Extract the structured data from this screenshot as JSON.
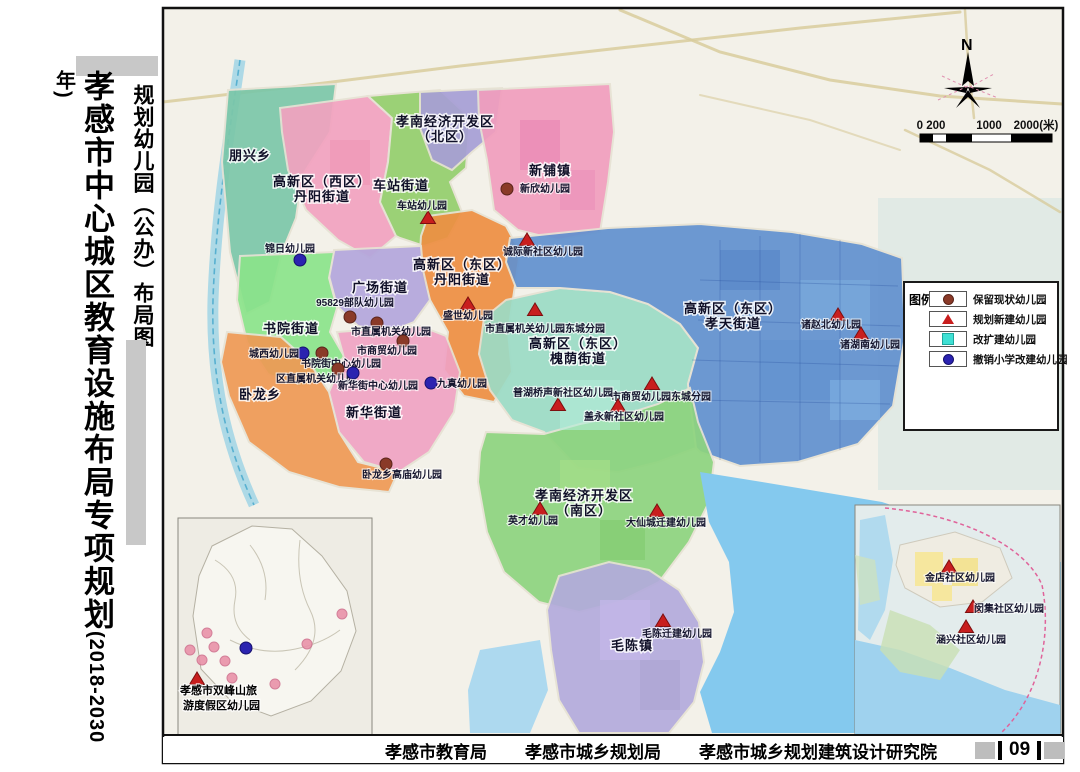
{
  "titles": {
    "main": "孝感市中心城区教育设施布局专项规划",
    "main_year": "(2018-2030年)",
    "sub": "规划幼儿园（公办）布局图"
  },
  "footer": {
    "agencies": [
      "孝感市教育局",
      "孝感市城乡规划局",
      "孝感市城乡规划建筑设计研究院"
    ],
    "page_number": "09"
  },
  "map": {
    "north_label": "N",
    "scale_ticks": [
      "0 200",
      "1000",
      "2000(米)"
    ],
    "legend": {
      "title": "图例：",
      "items": [
        {
          "symbol": "circle",
          "color": "#8a3a28",
          "edge": "#5a241a",
          "label": "保留现状幼儿园"
        },
        {
          "symbol": "triangle",
          "color": "#c81e1e",
          "edge": "#7d0f0f",
          "label": "规划新建幼儿园"
        },
        {
          "symbol": "square",
          "color": "#3fe0d4",
          "edge": "#1fa89e",
          "label": "改扩建幼儿园"
        },
        {
          "symbol": "circle",
          "color": "#2b23b0",
          "edge": "#16106e",
          "label": "撤销小学改建幼儿园"
        }
      ]
    },
    "marker_styles": {
      "existing": {
        "shape": "circle",
        "fill": "#8a3a28",
        "edge": "#5a241a"
      },
      "planned": {
        "shape": "triangle",
        "fill": "#c81e1e",
        "edge": "#7d0f0f"
      },
      "converted": {
        "shape": "circle",
        "fill": "#2b23b0",
        "edge": "#16106e"
      },
      "inset_existing": {
        "shape": "circle",
        "fill": "#e98fa7",
        "edge": "#cf6f8d"
      }
    },
    "districts": [
      {
        "id": "pengxing-township",
        "color": "#7cc7a9",
        "label_lines": [
          "朋兴乡"
        ],
        "label_x": 250,
        "label_y": 160,
        "points": "228,90 336,84 330,132 302,176 296,218 282,252 270,302 246,314 230,252 222,162"
      },
      {
        "id": "gaoxin-west-danyang",
        "color": "#f2a2c0",
        "label_lines": [
          "高新区（西区）",
          "丹阳街道"
        ],
        "label_x": 322,
        "label_y": 186,
        "points": "280,108 368,96 392,118 388,162 380,202 396,236 370,258 338,240 306,210 288,170 282,132"
      },
      {
        "id": "chezhan-street",
        "color": "#94cf6d",
        "label_lines": [
          "车站街道"
        ],
        "label_x": 401,
        "label_y": 190,
        "points": "368,96 440,90 470,118 466,168 450,182 462,212 448,238 424,246 400,238 396,236 380,202 388,162 392,118"
      },
      {
        "id": "kaifaqu-north",
        "color": "#a79fd6",
        "label_lines": [
          "孝南经济开发区",
          "（北区）"
        ],
        "label_x": 445,
        "label_y": 126,
        "points": "420,92 502,88 496,132 472,152 452,170 432,160 420,128"
      },
      {
        "id": "xinpu-town",
        "color": "#f19ebe",
        "label_lines": [
          "新铺镇"
        ],
        "label_x": 550,
        "label_y": 175,
        "points": "478,90 610,84 614,132 608,182 600,232 558,240 518,230 494,210 487,160 479,120"
      },
      {
        "id": "gaoxin-east-danyang",
        "color": "#ee8f42",
        "label_lines": [
          "高新区（东区）",
          "丹阳街道"
        ],
        "label_x": 462,
        "label_y": 269,
        "points": "428,216 472,210 506,226 520,252 514,292 508,332 512,372 494,402 464,396 444,370 448,332 430,300 419,268 421,236"
      },
      {
        "id": "guangchang-street",
        "color": "#b4a7dc",
        "label_lines": [
          "广场街道"
        ],
        "label_x": 380,
        "label_y": 292,
        "points": "334,250 421,246 423,270 430,300 414,322 388,332 358,326 337,306 329,276"
      },
      {
        "id": "shuyuan-street",
        "color": "#8be48b",
        "label_lines": [
          "书院街道"
        ],
        "label_x": 291,
        "label_y": 333,
        "points": "240,256 334,252 329,278 337,308 330,332 344,356 329,380 299,387 268,374 247,342 237,300"
      },
      {
        "id": "xinhua-street",
        "color": "#f0a3c4",
        "label_lines": [
          "新华街道"
        ],
        "label_x": 374,
        "label_y": 417,
        "points": "337,332 420,326 446,336 460,372 454,412 429,452 399,472 364,462 339,432 329,392 344,358"
      },
      {
        "id": "wolong-township",
        "color": "#ef9a55",
        "label_lines": [
          "卧龙乡"
        ],
        "label_x": 260,
        "label_y": 399,
        "points": "227,332 281,337 309,362 329,392 339,432 358,462 398,472 389,492 339,487 289,472 249,442 229,396 221,362"
      },
      {
        "id": "gaoxin-east-huaiyin",
        "color": "#9cdcc6",
        "label_lines": [
          "高新区（东区）",
          "槐荫街道"
        ],
        "label_x": 578,
        "label_y": 348,
        "points": "506,300 560,288 610,292 648,304 680,324 698,348 688,384 696,448 658,462 618,472 578,468 544,432 512,420 490,390 479,354 484,318"
      },
      {
        "id": "gaoxin-east-xiaotian",
        "color": "#6191cf",
        "label_lines": [
          "高新区（东区）",
          "孝天街道"
        ],
        "label_x": 733,
        "label_y": 313,
        "points": "510,238 608,228 700,224 792,232 862,244 902,258 905,336 893,406 858,444 798,462 740,466 700,452 696,448 688,384 698,348 680,324 648,304 610,292 560,288 516,288 506,262"
      },
      {
        "id": "kaifaqu-south",
        "color": "#8ed47f",
        "label_lines": [
          "孝南经济开发区",
          "（南区）"
        ],
        "label_x": 584,
        "label_y": 500,
        "points": "486,432 544,434 580,424 620,416 658,404 690,388 698,422 714,462 709,502 689,542 659,582 619,602 579,612 539,602 504,572 487,532 478,482 480,452"
      },
      {
        "id": "maochen-town",
        "color": "#b3abdc",
        "label_lines": [
          "毛陈镇"
        ],
        "label_x": 632,
        "label_y": 650,
        "points": "559,576 609,562 649,570 679,590 699,622 704,662 694,702 669,733 579,733 559,700 551,650 547,610"
      }
    ],
    "markers": [
      {
        "type": "existing",
        "x": 507,
        "y": 189,
        "label": "新欣幼儿园",
        "lx": 545,
        "ly": 192,
        "anchor": "middle"
      },
      {
        "type": "existing",
        "x": 350,
        "y": 317,
        "label": "95829部队幼儿园",
        "lx": 355,
        "ly": 306,
        "anchor": "middle"
      },
      {
        "type": "existing",
        "x": 377,
        "y": 323,
        "label": "市直属机关幼儿园",
        "lx": 391,
        "ly": 335,
        "anchor": "middle"
      },
      {
        "type": "existing",
        "x": 403,
        "y": 341,
        "label": "市商贸幼儿园",
        "lx": 387,
        "ly": 354,
        "anchor": "middle"
      },
      {
        "type": "existing",
        "x": 322,
        "y": 353,
        "label": "书院街中心幼儿园",
        "lx": 341,
        "ly": 367,
        "anchor": "middle"
      },
      {
        "type": "existing",
        "x": 338,
        "y": 369,
        "label": "区直属机关幼儿园",
        "lx": 316,
        "ly": 382,
        "anchor": "middle"
      },
      {
        "type": "existing",
        "x": 386,
        "y": 464,
        "label": "卧龙乡高庙幼儿园",
        "lx": 402,
        "ly": 478,
        "anchor": "middle"
      },
      {
        "type": "converted",
        "x": 300,
        "y": 260,
        "label": "锦日幼儿园",
        "lx": 290,
        "ly": 252,
        "anchor": "middle"
      },
      {
        "type": "converted",
        "x": 303,
        "y": 353,
        "label": "城西幼儿园",
        "lx": 274,
        "ly": 357,
        "anchor": "middle"
      },
      {
        "type": "converted",
        "x": 353,
        "y": 373,
        "label": "新华街中心幼儿园",
        "lx": 378,
        "ly": 389,
        "anchor": "middle"
      },
      {
        "type": "converted",
        "x": 431,
        "y": 383,
        "label": "九真幼儿园",
        "lx": 462,
        "ly": 387,
        "anchor": "middle"
      },
      {
        "type": "planned",
        "x": 428,
        "y": 218,
        "label": "车站幼儿园",
        "lx": 422,
        "ly": 209,
        "anchor": "middle"
      },
      {
        "type": "planned",
        "x": 527,
        "y": 240,
        "label": "诚际新社区幼儿园",
        "lx": 543,
        "ly": 255,
        "anchor": "middle"
      },
      {
        "type": "planned",
        "x": 468,
        "y": 304,
        "label": "盛世幼儿园",
        "lx": 468,
        "ly": 319,
        "anchor": "middle"
      },
      {
        "type": "planned",
        "x": 535,
        "y": 310,
        "label": "市直属机关幼儿园东城分园",
        "lx": 545,
        "ly": 332,
        "anchor": "middle"
      },
      {
        "type": "planned",
        "x": 652,
        "y": 384,
        "label": "市商贸幼儿园东城分园",
        "lx": 661,
        "ly": 400,
        "anchor": "middle"
      },
      {
        "type": "planned",
        "x": 558,
        "y": 405,
        "label": "普湖桥声新社区幼儿园",
        "lx": 563,
        "ly": 396,
        "anchor": "middle"
      },
      {
        "type": "planned",
        "x": 618,
        "y": 406,
        "label": "盖永新社区幼儿园",
        "lx": 624,
        "ly": 420,
        "anchor": "middle"
      },
      {
        "type": "planned",
        "x": 540,
        "y": 509,
        "label": "英才幼儿园",
        "lx": 533,
        "ly": 524,
        "anchor": "middle"
      },
      {
        "type": "planned",
        "x": 657,
        "y": 511,
        "label": "大仙城迁建幼儿园",
        "lx": 666,
        "ly": 526,
        "anchor": "middle"
      },
      {
        "type": "planned",
        "x": 663,
        "y": 621,
        "label": "毛陈迁建幼儿园",
        "lx": 677,
        "ly": 637,
        "anchor": "middle"
      },
      {
        "type": "planned",
        "x": 838,
        "y": 315,
        "label": "诸赵北幼儿园",
        "lx": 831,
        "ly": 328,
        "anchor": "middle"
      },
      {
        "type": "planned",
        "x": 861,
        "y": 334,
        "label": "诸湖南幼儿园",
        "lx": 870,
        "ly": 348,
        "anchor": "middle"
      },
      {
        "type": "planned",
        "x": 949,
        "y": 567,
        "label": "金店社区幼儿园",
        "lx": 960,
        "ly": 581,
        "anchor": "middle"
      },
      {
        "type": "planned",
        "x": 973,
        "y": 607,
        "label": "闵集社区幼儿园",
        "lx": 1009,
        "ly": 612,
        "anchor": "middle"
      },
      {
        "type": "planned",
        "x": 966,
        "y": 627,
        "label": "涵兴社区幼儿园",
        "lx": 971,
        "ly": 643,
        "anchor": "middle"
      },
      {
        "type": "planned",
        "x": 197,
        "y": 679,
        "label": "",
        "lx": 0,
        "ly": 0,
        "anchor": "middle"
      },
      {
        "type": "converted",
        "x": 246,
        "y": 648,
        "label": "",
        "lx": 0,
        "ly": 0,
        "anchor": "middle"
      },
      {
        "type": "inset_existing",
        "x": 207,
        "y": 633,
        "label": ""
      },
      {
        "type": "inset_existing",
        "x": 190,
        "y": 650,
        "label": ""
      },
      {
        "type": "inset_existing",
        "x": 202,
        "y": 660,
        "label": ""
      },
      {
        "type": "inset_existing",
        "x": 225,
        "y": 661,
        "label": ""
      },
      {
        "type": "inset_existing",
        "x": 275,
        "y": 684,
        "label": ""
      },
      {
        "type": "inset_existing",
        "x": 342,
        "y": 614,
        "label": ""
      },
      {
        "type": "inset_existing",
        "x": 307,
        "y": 644,
        "label": ""
      },
      {
        "type": "inset_existing",
        "x": 214,
        "y": 647,
        "label": ""
      },
      {
        "type": "inset_existing",
        "x": 232,
        "y": 678,
        "label": ""
      }
    ],
    "insets": {
      "left": {
        "line1": "孝感市双峰山旅",
        "line2": "游度假区幼儿园"
      }
    }
  }
}
